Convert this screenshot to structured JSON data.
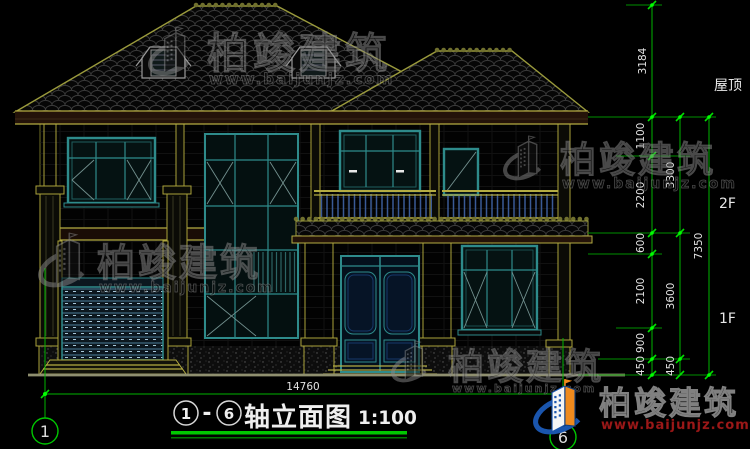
{
  "title": {
    "axis_from": "1",
    "separator": "-",
    "axis_to": "6",
    "name": "轴立面图",
    "scale": "1:100"
  },
  "axis_bubbles": {
    "left": "1",
    "right": "6"
  },
  "levels": {
    "roof_label": "屋顶",
    "floor2_label": "2F",
    "floor1_label": "1F"
  },
  "dimensions": {
    "total_width": "14760",
    "right_col1": {
      "roof_rise": "3184",
      "win_top": "1100",
      "f2_main": "2200",
      "canopy": "600",
      "f1_main": "2100",
      "sill": "900",
      "plinth": "450"
    },
    "right_col2": {
      "f2_total": "3300",
      "f1_total": "3600",
      "plinth": "450"
    },
    "right_col3": {
      "overall": "7350"
    }
  },
  "watermark": {
    "brand": "柏竣建筑",
    "url": "www.baijunjz.com"
  },
  "colors": {
    "background": "#000000",
    "cad_line_yellow": "#AAA23A",
    "cad_dimension_green": "#00B400",
    "window_frame_teal": "#2E8B8B",
    "text_white": "#E2E2E2",
    "logo_blue": "#1A55AD",
    "logo_orange": "#EF8A1D",
    "watermark_url_red": "#9C1818"
  }
}
